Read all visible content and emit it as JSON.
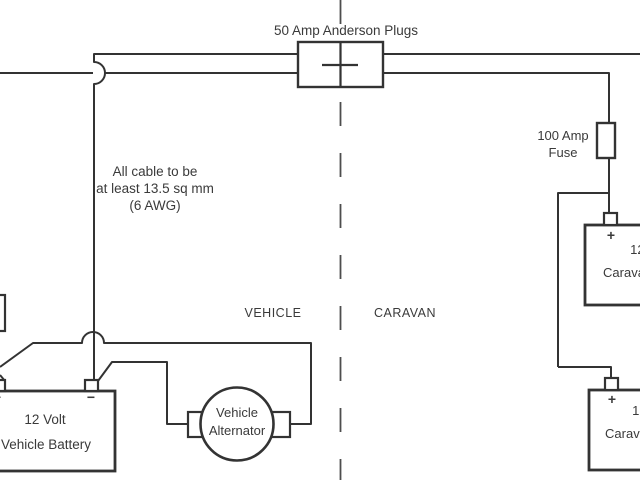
{
  "colors": {
    "background": "#ffffff",
    "ink": "#333333",
    "text": "#3a3a3a",
    "divider": "#4d4d4d"
  },
  "labels": {
    "anderson_plug": "50 Amp Anderson Plugs",
    "cable_note": {
      "line1": "All cable to be",
      "line2": "at least 13.5 sq mm",
      "line3": "(6 AWG)"
    },
    "fuse": {
      "line1": "100 Amp",
      "line2": "Fuse"
    },
    "zones": {
      "vehicle": "VEHICLE",
      "caravan": "CARAVAN"
    },
    "vehicle_battery": {
      "line1": "12 Volt",
      "line2": "Vehicle Battery",
      "negative_mark": "−",
      "positive_mark": "+"
    },
    "alternator": {
      "line1": "Vehicle",
      "line2": "Alternator"
    },
    "caravan_battery_top": {
      "line1": "12 Volt",
      "line2": "Caravan Battery",
      "positive_mark": "+"
    },
    "caravan_battery_bottom": {
      "line1": "12 Volt",
      "line2": "Caravan Battery",
      "positive_mark": "+"
    }
  }
}
